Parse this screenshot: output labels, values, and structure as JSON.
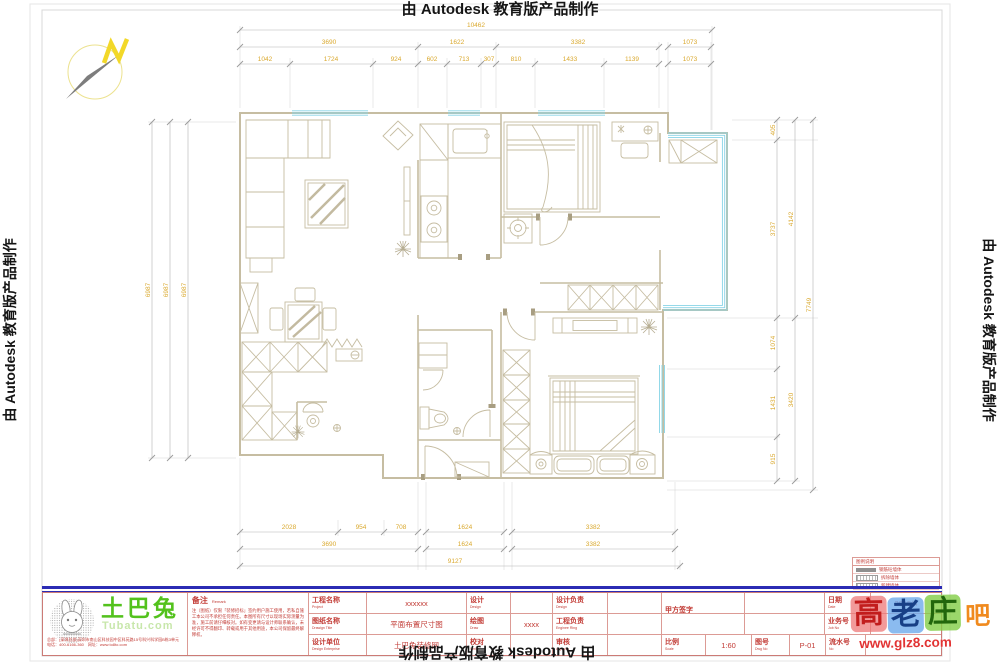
{
  "page": {
    "autodesk_text": "由 Autodesk 教育版产品制作"
  },
  "compass": {
    "label": "N"
  },
  "dims": {
    "top": {
      "total": "10462",
      "row2": [
        "3690",
        "1622",
        "3382",
        "1073"
      ],
      "row3": [
        "1042",
        "1724",
        "924",
        "602",
        "713",
        "307",
        "810",
        "1433",
        "1139",
        "1073"
      ]
    },
    "bottom": {
      "row1": [
        "2028",
        "954",
        "708",
        "1624",
        "3382"
      ],
      "row2": [
        "3690",
        "1624",
        "3382"
      ],
      "total": "9127"
    },
    "left": [
      "6987",
      "6987",
      "6987"
    ],
    "right": {
      "col1": [
        "405",
        "3737",
        "1074",
        "1431",
        "915"
      ],
      "col2": [
        "4142",
        "3420"
      ],
      "col3": "7749"
    }
  },
  "legend": {
    "title": "图例说明",
    "items": [
      {
        "label": "钢筋砼墙体"
      },
      {
        "label": "拆除墙体"
      },
      {
        "label": "新建墙体"
      }
    ]
  },
  "titleblock": {
    "logo": {
      "name": "土巴兔",
      "domain": "Tubatu.com",
      "contact1": "总部：(深圳总部)深圳市南山区科技园中区科苑路15号科兴科学园B栋3单元",
      "contact2": "电话：400-6166-360　网址：www.to8to.com"
    },
    "remark": {
      "label": "备注",
      "label_en": "Remark",
      "text": "注（图纸）仅限「装修招标」签约用户施工使用，若私自施工本公司不承担任何责任。本图所有尺寸以现场实际测量为准，施工前请仔细核对。如有变更请与设计师联系确认，未经许可不得翻印、转载或用于其他用途，本公司保留最终解释权。"
    },
    "fields": {
      "project_label": "工程名称",
      "project_en": "Project",
      "project_value": "xxxxxx",
      "drawing_label": "图纸名称",
      "drawing_en": "Drawign Title",
      "drawing_value": "平面布置尺寸图",
      "enterprise_label": "设计单位",
      "enterprise_en": "Design Enterprise",
      "enterprise_value": "土巴兔装修网",
      "design_label": "设计",
      "design_en": "Design",
      "design_value": "",
      "draw_label": "绘图",
      "draw_en": "Draw",
      "draw_value": "xxxx",
      "verify_label": "校对",
      "verify_en": "Verify",
      "verify_value": "",
      "design_lead_label": "设计负责",
      "design_lead_en": "Design",
      "eng_lead_label": "工程负责",
      "eng_lead_en": "Enginee Ring",
      "approve_label": "审核",
      "approve_en": "Approve",
      "customer_label": "甲方签字",
      "customer_en": "Customer Signature",
      "date_label": "日期",
      "date_en": "Date",
      "date_value": "2015/4",
      "job_label": "业务号",
      "job_en": "Job No",
      "scale_label": "比例",
      "scale_en": "Scale",
      "scale_value": "1:60",
      "dwg_label": "图号",
      "dwg_en": "Dwg No",
      "dwg_value": "P-01",
      "serial_label": "流水号",
      "serial_en": "No"
    }
  },
  "watermark": {
    "char1": "高",
    "char2": "老",
    "char3": "庄",
    "char4": "吧",
    "url": "www.glz8.com"
  }
}
